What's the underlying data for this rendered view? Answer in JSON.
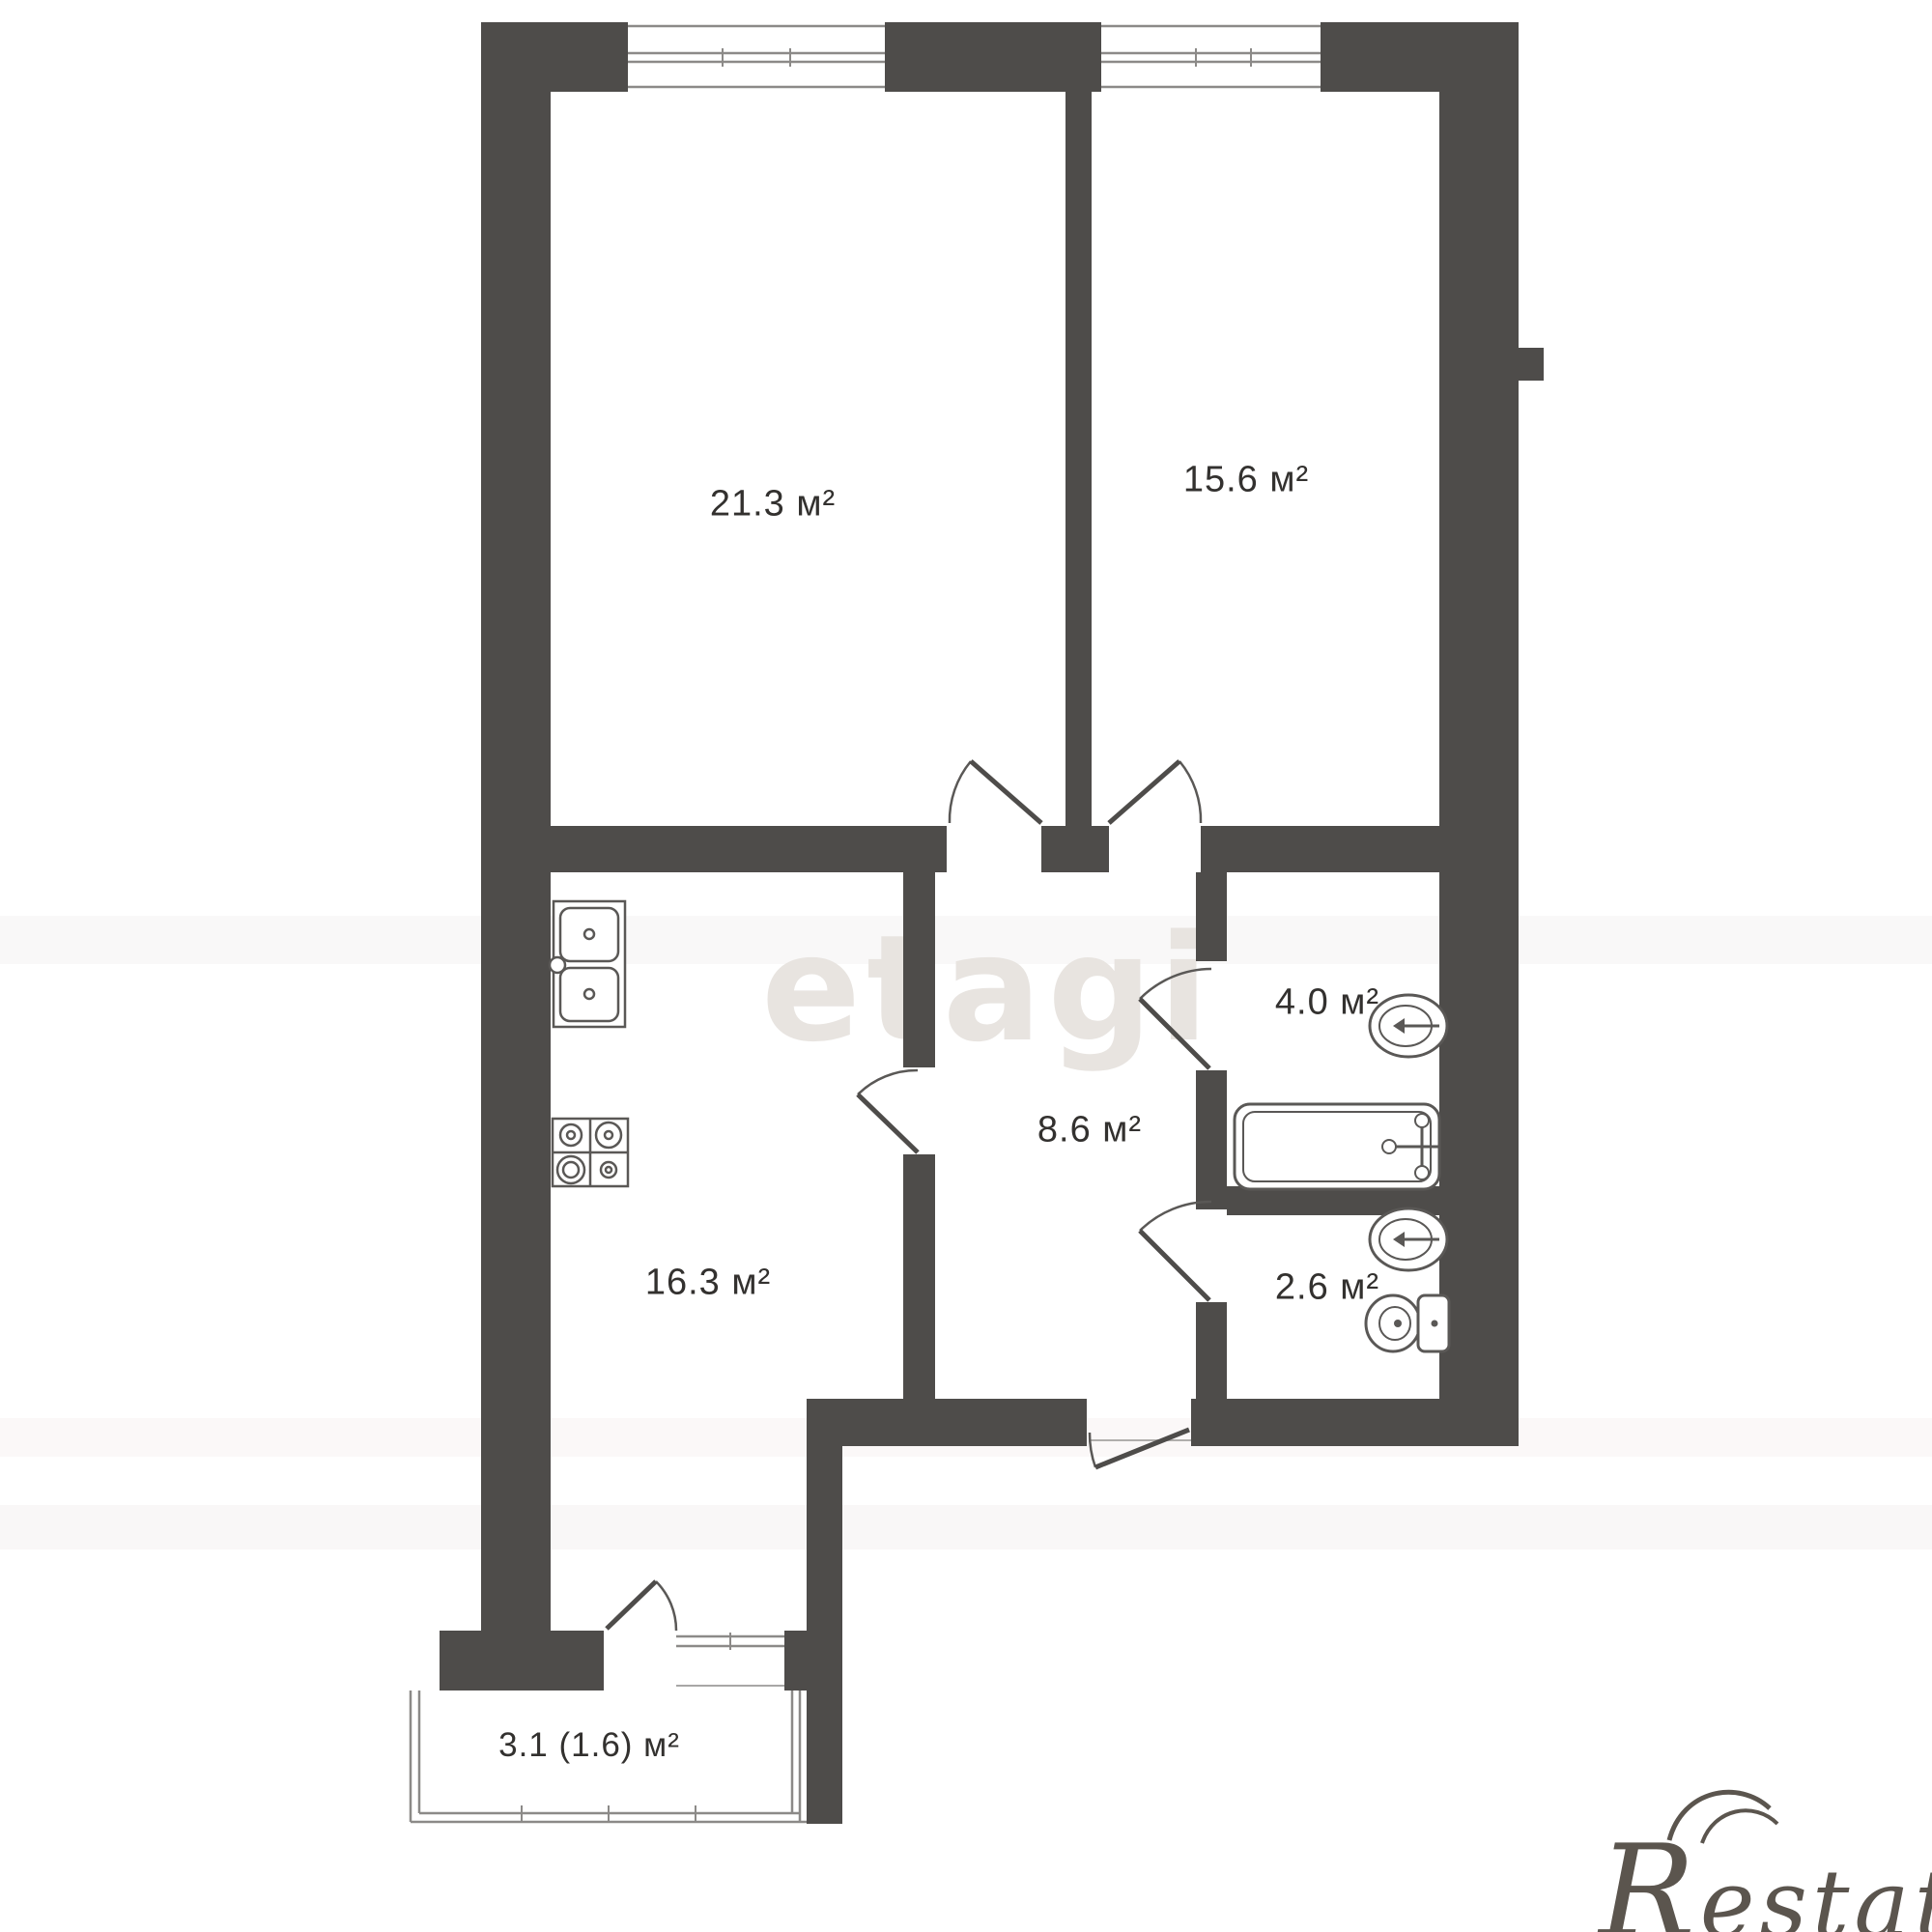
{
  "rooms": [
    {
      "name": "living-room",
      "label": "21.3 м²",
      "area_m2": 21.3
    },
    {
      "name": "bedroom",
      "label": "15.6 м²",
      "area_m2": 15.6
    },
    {
      "name": "kitchen",
      "label": "16.3 м²",
      "area_m2": 16.3
    },
    {
      "name": "hallway",
      "label": "8.6 м²",
      "area_m2": 8.6
    },
    {
      "name": "bathroom",
      "label": "4.0 м²",
      "area_m2": 4.0
    },
    {
      "name": "toilet-room",
      "label": "2.6 м²",
      "area_m2": 2.6
    },
    {
      "name": "balcony",
      "label": "3.1 (1.6) м²",
      "area_m2": 3.1,
      "area_reduced_m2": 1.6
    }
  ],
  "watermarks": {
    "center": "etagi",
    "corner": "Restate"
  },
  "colors": {
    "wall": "#4e4c4a",
    "background": "#ffffff",
    "label_text": "#33312f",
    "watermark_center": "#e8e4e0",
    "watermark_corner": "#5b554e",
    "fixture_stroke": "#5a5856"
  },
  "fixtures": [
    "kitchen-sink-icon",
    "stove-icon",
    "bathtub-icon",
    "washbasin-icon-bathroom",
    "washbasin-icon-toilet",
    "toilet-icon"
  ],
  "openings": {
    "windows": 3,
    "doors": [
      "living-room-door",
      "bedroom-door",
      "bathroom-door",
      "toilet-door",
      "kitchen-door",
      "entrance-door",
      "balcony-door"
    ]
  }
}
